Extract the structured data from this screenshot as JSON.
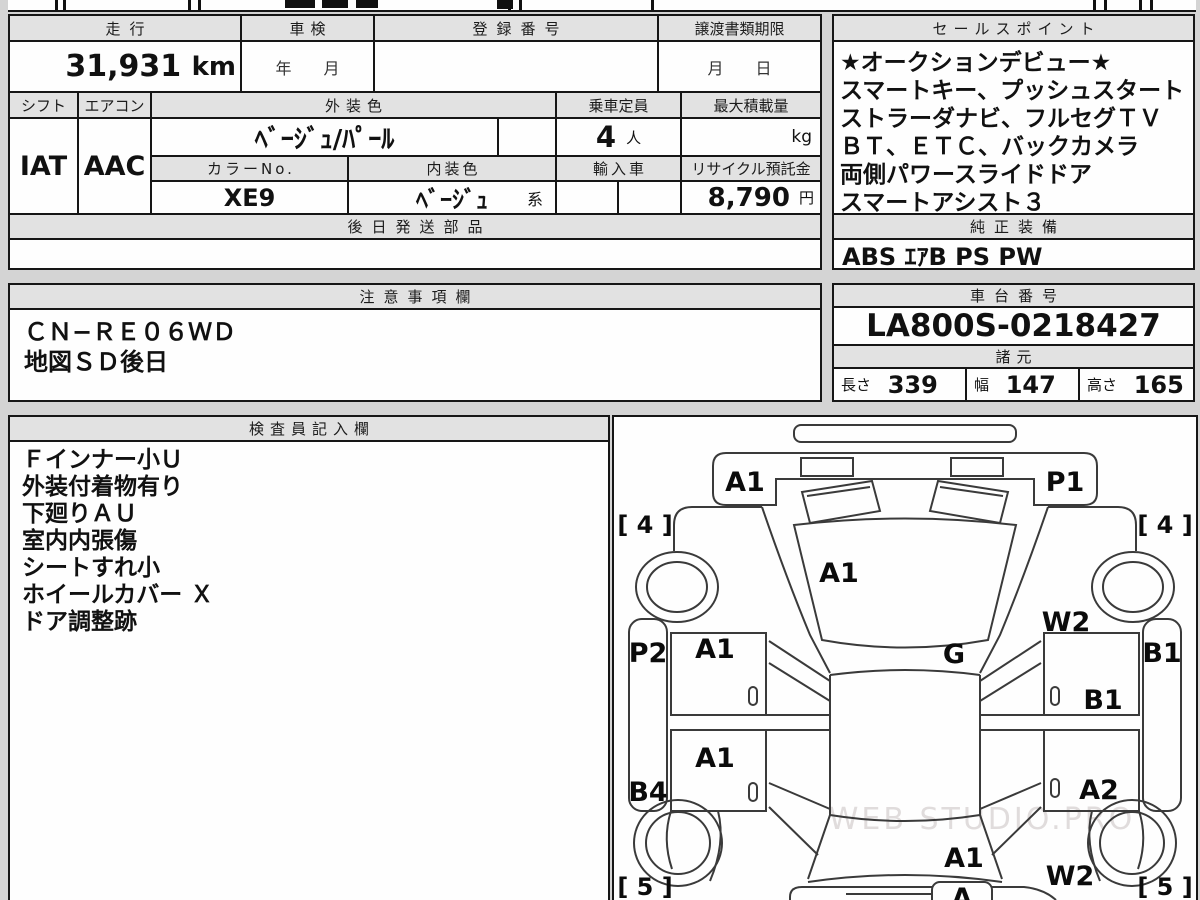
{
  "doc": {
    "type": "auction-sheet",
    "watermark": "WEB STUDIO.PRO"
  },
  "top_table": {
    "mileage_header": "走行",
    "mileage_value": "31,931",
    "mileage_unit": "km",
    "shaken_header": "車検",
    "shaken_value": "年　　月",
    "registration_header": "登録番号",
    "registration_value": "",
    "transfer_doc_header": "譲渡書類期限",
    "transfer_doc_value": "月　　日",
    "shift_header": "シフト",
    "shift_value": "IAT",
    "aircon_header": "エアコン",
    "aircon_value": "AAC",
    "exterior_color_header": "外装色",
    "exterior_color_value": "ﾍﾞｰｼﾞｭ/ﾊﾟｰﾙ",
    "capacity_header": "乗車定員",
    "capacity_value": "4",
    "capacity_unit": "人",
    "payload_header": "最大積載量",
    "payload_unit": "kg",
    "color_no_header": "カラーNo.",
    "color_no_value": "XE9",
    "interior_color_header": "内装色",
    "interior_color_value": "ﾍﾞｰｼﾞｭ",
    "interior_color_suffix": "系",
    "import_header": "輸入車",
    "recycle_header": "リサイクル預託金",
    "recycle_value": "8,790",
    "recycle_unit": "円",
    "later_parts_header": "後日発送部品",
    "later_parts_value": ""
  },
  "sales_point": {
    "title": "セールスポイント",
    "lines": [
      "★オークションデビュー★",
      "スマートキー、プッシュスタート",
      "ストラーダナビ、フルセグＴＶ",
      "ＢＴ、ＥＴＣ、バックカメラ",
      "両側パワースライドドア",
      "スマートアシスト３"
    ]
  },
  "equipment": {
    "title": "純正装備",
    "value": "ABS ｴｱB PS PW"
  },
  "notes": {
    "title": "注意事項欄",
    "lines": [
      "ＣＮ−ＲＥ０６ＷＤ",
      "地図ＳＤ後日"
    ]
  },
  "chassis": {
    "title": "車台番号",
    "value": "LA800S-0218427"
  },
  "specs": {
    "title": "諸元",
    "length_label": "長さ",
    "length_value": "339",
    "width_label": "幅",
    "width_value": "147",
    "height_label": "高さ",
    "height_value": "165"
  },
  "inspector": {
    "title": "検査員記入欄",
    "lines": [
      "Ｆインナー小Ｕ",
      "外装付着物有り",
      "下廻りＡＵ",
      "室内内張傷",
      "シートすれ小",
      "ホイールカバー Ｘ",
      "ドア調整跡"
    ]
  },
  "diagram": {
    "front_panel_left": "A1",
    "front_panel_right": "P1",
    "tire_front_left": "[ 4 ]",
    "tire_front_right": "[ 4 ]",
    "windshield": "A1",
    "front_right_fender": "W2",
    "left_rocker_front": "P2",
    "front_left_door": "A1",
    "roof": "G",
    "right_rocker": "B1",
    "front_right_door": "B1",
    "left_rocker_rear": "B4",
    "rear_left_door": "A1",
    "rear_right_door": "A2",
    "rear_window": "A1",
    "rear_right_fender": "W2",
    "tire_rear_left": "[ 5 ]",
    "tire_rear_right": "[ 5 ]",
    "rear_hatch": "A"
  }
}
